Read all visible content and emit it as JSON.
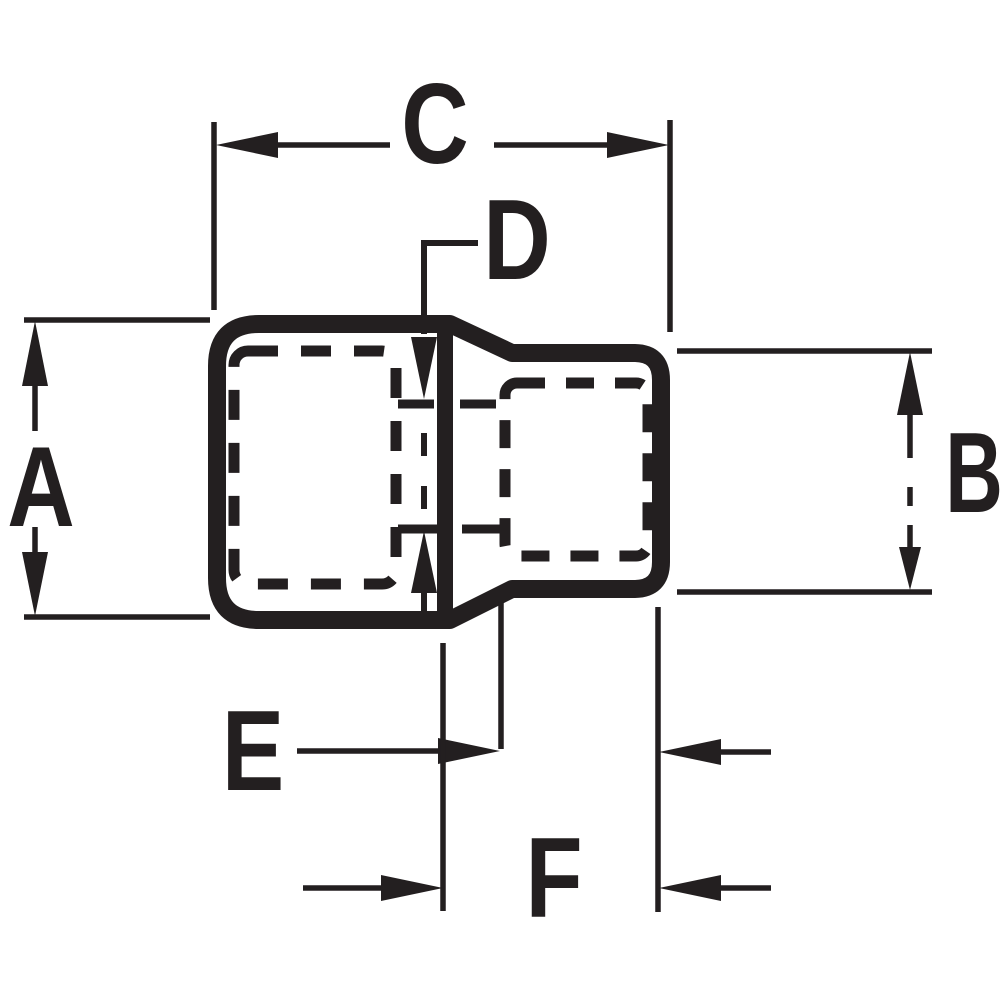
{
  "drawing": {
    "kind": "dimension-diagram",
    "labels": {
      "a": "A",
      "b": "B",
      "c": "C",
      "d": "D",
      "e": "E",
      "f": "F"
    },
    "colors": {
      "line": "#231f20",
      "background": "#ffffff"
    }
  }
}
